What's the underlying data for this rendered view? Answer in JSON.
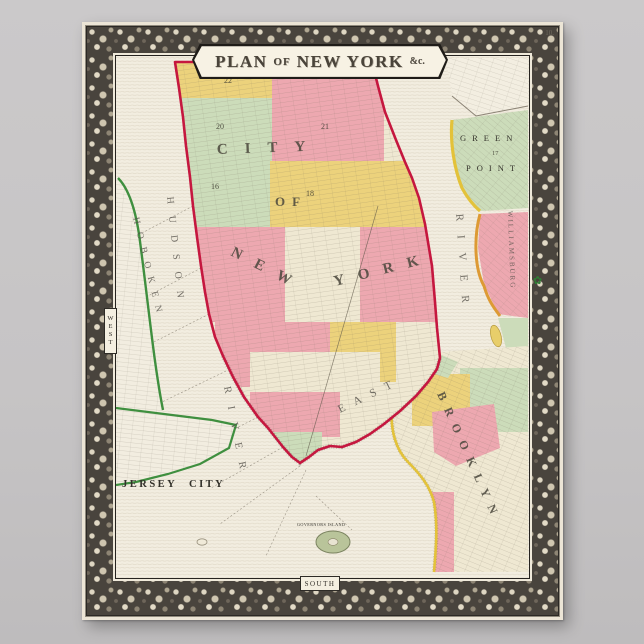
{
  "poster": {
    "page_number": "10.",
    "cartouche": {
      "plan": "PLAN",
      "of": "OF",
      "new_york": "NEW YORK",
      "etc": "&c."
    },
    "border_compass": {
      "west": "WEST",
      "south": "SOUTH"
    }
  },
  "icons": {
    "flower": "✿"
  },
  "map": {
    "manhattan": {
      "city": "CITY",
      "of": "OF",
      "new": "NEW",
      "york": "YORK",
      "wards": {
        "w22": "22",
        "w20": "20",
        "w21": "21",
        "w16": "16",
        "w18": "18"
      }
    },
    "hudson": {
      "hudson": "HUDSON",
      "river": "RIVER"
    },
    "east_river": {
      "east": "EAST",
      "river": "RIVER"
    },
    "jersey": {
      "hoboken": "HOBOKEN",
      "jersey_city": "JERSEY CITY"
    },
    "long_island": {
      "green": "GREEN",
      "point": "POINT",
      "ward17": "17",
      "williamsburg": "WILLIAMSBURG",
      "brooklyn": "BROOKLYN"
    },
    "islands": {
      "governors": "GOVERNORS ISLAND"
    }
  },
  "colors": {
    "background": "#c6c4c5",
    "paper": "#efe9dc",
    "water": "#f2ede0",
    "manhattan_outline": "#c5173f",
    "ward_pink": "#eda8b0",
    "ward_yellow": "#ecd27c",
    "ward_green": "#ccdcba",
    "ward_cream": "#efe8d2",
    "shore_green": "#3f8f3f",
    "shore_yellow": "#e3c23a",
    "shore_orange": "#dd9a34"
  }
}
